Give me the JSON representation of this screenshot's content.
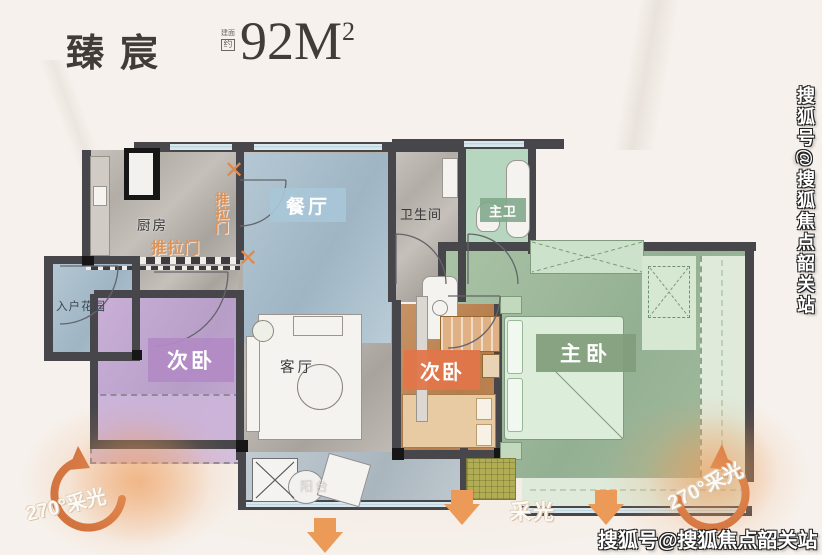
{
  "header": {
    "brand": "臻宸",
    "area_small_top": "建面",
    "area_small_box": "约",
    "area_value": "92M",
    "area_sup": "2"
  },
  "rooms": {
    "kitchen": "厨房",
    "dining": "餐厅",
    "bath": "卫生间",
    "master_bath": "主卫",
    "entry_garden": "入户花园",
    "bedroom_left": "次卧",
    "living": "客厅",
    "bedroom_right": "次卧",
    "master": "主卧",
    "balcony": "阳台"
  },
  "annotations": {
    "sliding_door": "推拉门",
    "sliding_door_vertical": "推拉门",
    "cross_mark": "✕",
    "daylight": "采光",
    "daylight_270": "270°采光"
  },
  "watermarks": {
    "bottom": "搜狐号@搜狐焦点韶关站",
    "side": "搜狐号@搜狐焦点韶关站"
  },
  "colors": {
    "background": "#f6f1ec",
    "accent_orange": "#ec9a58",
    "curved_arrow": "#d0703e",
    "dining_blue": "#a9bdc9",
    "bedroom_purple": "#c0a3ce",
    "bedroom_orange": "#c08457",
    "master_green": "#a0bc9e",
    "master_bath_green": "#b7d6bf",
    "wall": "#46464b"
  }
}
